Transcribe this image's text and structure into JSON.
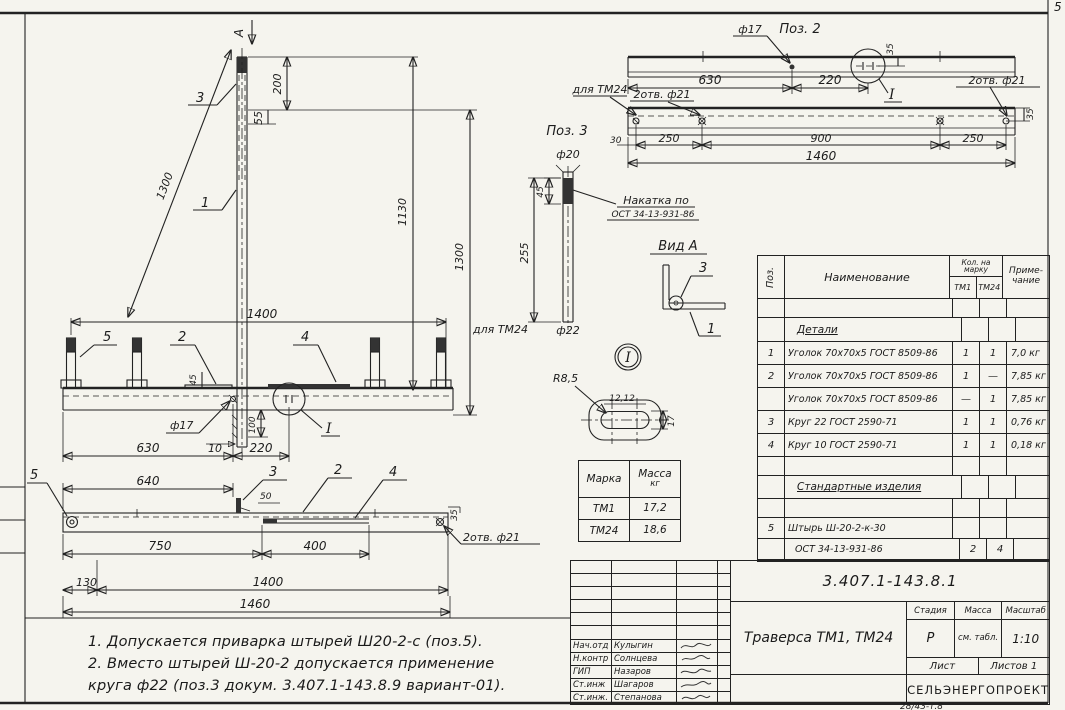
{
  "sheet": {
    "corner_number": "5",
    "footer_code": "28/43-т.8",
    "notes_line1": "1. Допускается приварка штырей Ш20-2-с (поз.5).",
    "notes_line2": "2. Вместо штырей Ш-20-2 допускается применение",
    "notes_line3": "круга ф22 (поз.3 докум. 3.407.1-143.8.9 вариант-01)."
  },
  "front": {
    "view_arrow_label": "А",
    "pos3_leader": "3",
    "pos1_leader": "1",
    "pos5_leader": "5",
    "pos2_leader": "2",
    "pos4_leader": "4",
    "dim_diagonal": "1300",
    "dim_top": "200",
    "dim_top_offset": "55",
    "dim_height_inner": "1130",
    "dim_height_outer": "1300",
    "dim_span": "1400",
    "label_tm24": "для ТМ24",
    "dim_weld": "45",
    "dim_hole": "ф17",
    "dim_gusset_offset": "10",
    "dim_gusset_height": "100",
    "dim_630": "630",
    "dim_220": "220",
    "section_mark": "I"
  },
  "plan": {
    "pos5_leader": "5",
    "pos3_leader": "3",
    "pos2_leader": "2",
    "pos4_leader": "4",
    "dim_640": "640",
    "dim_50": "50",
    "dim_750": "750",
    "dim_400": "400",
    "dim_130": "130",
    "dim_1400": "1400",
    "dim_1460": "1460",
    "dim_35": "35",
    "label_holes": "2отв. ф21"
  },
  "pos2": {
    "title": "Поз. 2",
    "dim_hole": "ф17",
    "dim_35_top": "35",
    "dim_630": "630",
    "dim_220": "220",
    "label_holes_right": "2отв. ф21",
    "label_tm24": "для ТМ24",
    "label_holes_left": "2отв. ф21",
    "dim_30": "30",
    "dim_250_left": "250",
    "dim_900": "900",
    "dim_250_right": "250",
    "dim_1460": "1460",
    "dim_35_right": "35",
    "section_mark": "I"
  },
  "pos3": {
    "title": "Поз. 3",
    "dim_d20": "ф20",
    "dim_45": "45",
    "dim_255": "255",
    "dim_d22": "ф22",
    "knurl_label1": "Накатка по",
    "knurl_label2": "ОСТ 34-13-931-86"
  },
  "vid_a": {
    "title": "Вид А",
    "pos3_leader": "3",
    "pos1_leader": "1"
  },
  "section_i": {
    "mark": "I",
    "radius": "R8,5",
    "dim_12": "12,12",
    "dim_17": "17"
  },
  "mass_table": {
    "col_marka": "Марка",
    "col_massa": "Масса",
    "unit": "кг",
    "rows": [
      {
        "marka": "ТМ1",
        "massa": "17,2"
      },
      {
        "marka": "ТМ24",
        "massa": "18,6"
      }
    ]
  },
  "spec": {
    "col_pos": "Поз.",
    "col_name": "Наименование",
    "col_qty1": "Кол. на",
    "col_qty2": "марку",
    "col_tm1": "ТМ1",
    "col_tm24": "ТМ24",
    "col_note1": "Приме-",
    "col_note2": "чание",
    "section1": "Детали",
    "rows": [
      {
        "pos": "1",
        "name": "Уголок 70х70х5 ГОСТ 8509-86",
        "tm1": "1",
        "tm24": "1",
        "note": "7,0 кг"
      },
      {
        "pos": "2",
        "name": "Уголок 70х70х5 ГОСТ 8509-86",
        "tm1": "1",
        "tm24": "—",
        "note": "7,85 кг"
      },
      {
        "pos": "",
        "name": "Уголок 70х70х5 ГОСТ 8509-86",
        "tm1": "—",
        "tm24": "1",
        "note": "7,85 кг"
      },
      {
        "pos": "3",
        "name": "Круг 22 ГОСТ 2590-71",
        "tm1": "1",
        "tm24": "1",
        "note": "0,76 кг"
      },
      {
        "pos": "4",
        "name": "Круг 10 ГОСТ 2590-71",
        "tm1": "1",
        "tm24": "1",
        "note": "0,18 кг"
      }
    ],
    "section2": "Стандартные изделия",
    "rows2": [
      {
        "pos": "5",
        "name": "Штырь Ш-20-2-к-30",
        "tm1": "",
        "tm24": "",
        "note": ""
      },
      {
        "pos": "",
        "name": "ОСТ 34-13-931-86",
        "tm1": "2",
        "tm24": "4",
        "note": ""
      }
    ]
  },
  "stamp": {
    "doc_number": "3.407.1-143.8.1",
    "title": "Траверса ТМ1, ТМ24",
    "stage_label": "Стадия",
    "mass_label": "Масса",
    "scale_label": "Масштаб",
    "stage": "Р",
    "mass": "см. табл.",
    "scale": "1:10",
    "sheet_label": "Лист",
    "sheets_label": "Листов 1",
    "org": "СЕЛЬЭНЕРГОПРОЕКТ",
    "rows": [
      {
        "role": "Нач.отд",
        "name": "Кулыгин"
      },
      {
        "role": "Н.контр",
        "name": "Солнцева"
      },
      {
        "role": "ГИП",
        "name": "Назаров"
      },
      {
        "role": "Ст.инж",
        "name": "Шагаров"
      },
      {
        "role": "Ст.инж.",
        "name": "Степанова"
      }
    ]
  }
}
